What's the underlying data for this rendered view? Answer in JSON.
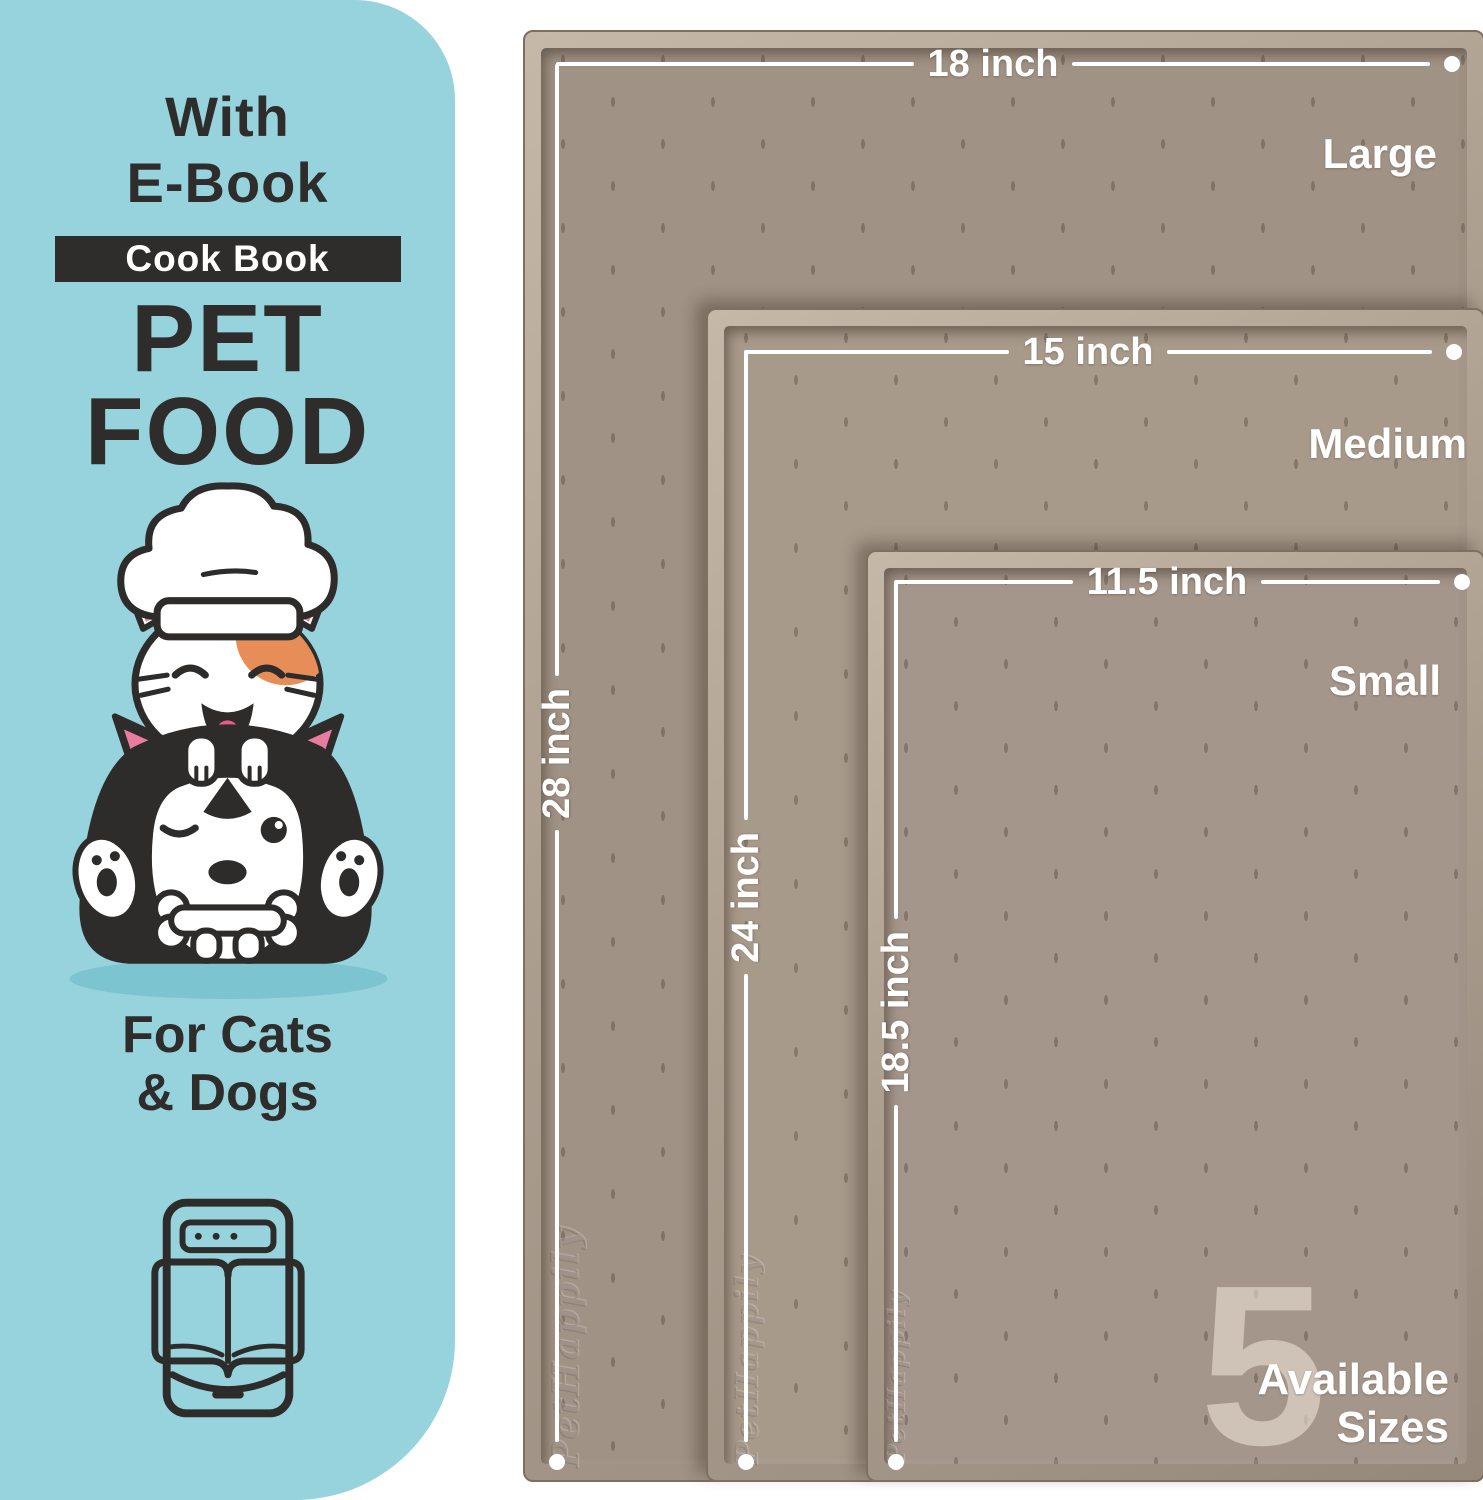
{
  "panel": {
    "with_label": "With",
    "ebook_label": "E-Book",
    "badge_label": "Cook Book",
    "title_line1": "PET",
    "title_line2": "FOOD",
    "subtitle_line1": "For Cats",
    "subtitle_line2": "& Dogs"
  },
  "mats": [
    {
      "label": "Large",
      "width_label": "18 inch",
      "height_label": "28 inch"
    },
    {
      "label": "Medium",
      "width_label": "15 inch",
      "height_label": "24 inch"
    },
    {
      "label": "Small",
      "width_label": "11.5 inch",
      "height_label": "18.5 inch"
    }
  ],
  "availability": {
    "count": "5",
    "line1": "Available",
    "line2": "Sizes"
  },
  "brand_emboss": "PetHappily",
  "colors": {
    "panel_bg": "#96d3dd",
    "ink": "#2e2d2c",
    "badge_bg": "#2e2d2c",
    "mat_large_surface": "#a09284",
    "mat_medium_surface": "#a89a8b",
    "mat_small_surface": "#a4968a",
    "measure_line": "#ffffff",
    "cat_patch_orange": "#e78e58",
    "ear_pink": "#e87da0"
  }
}
